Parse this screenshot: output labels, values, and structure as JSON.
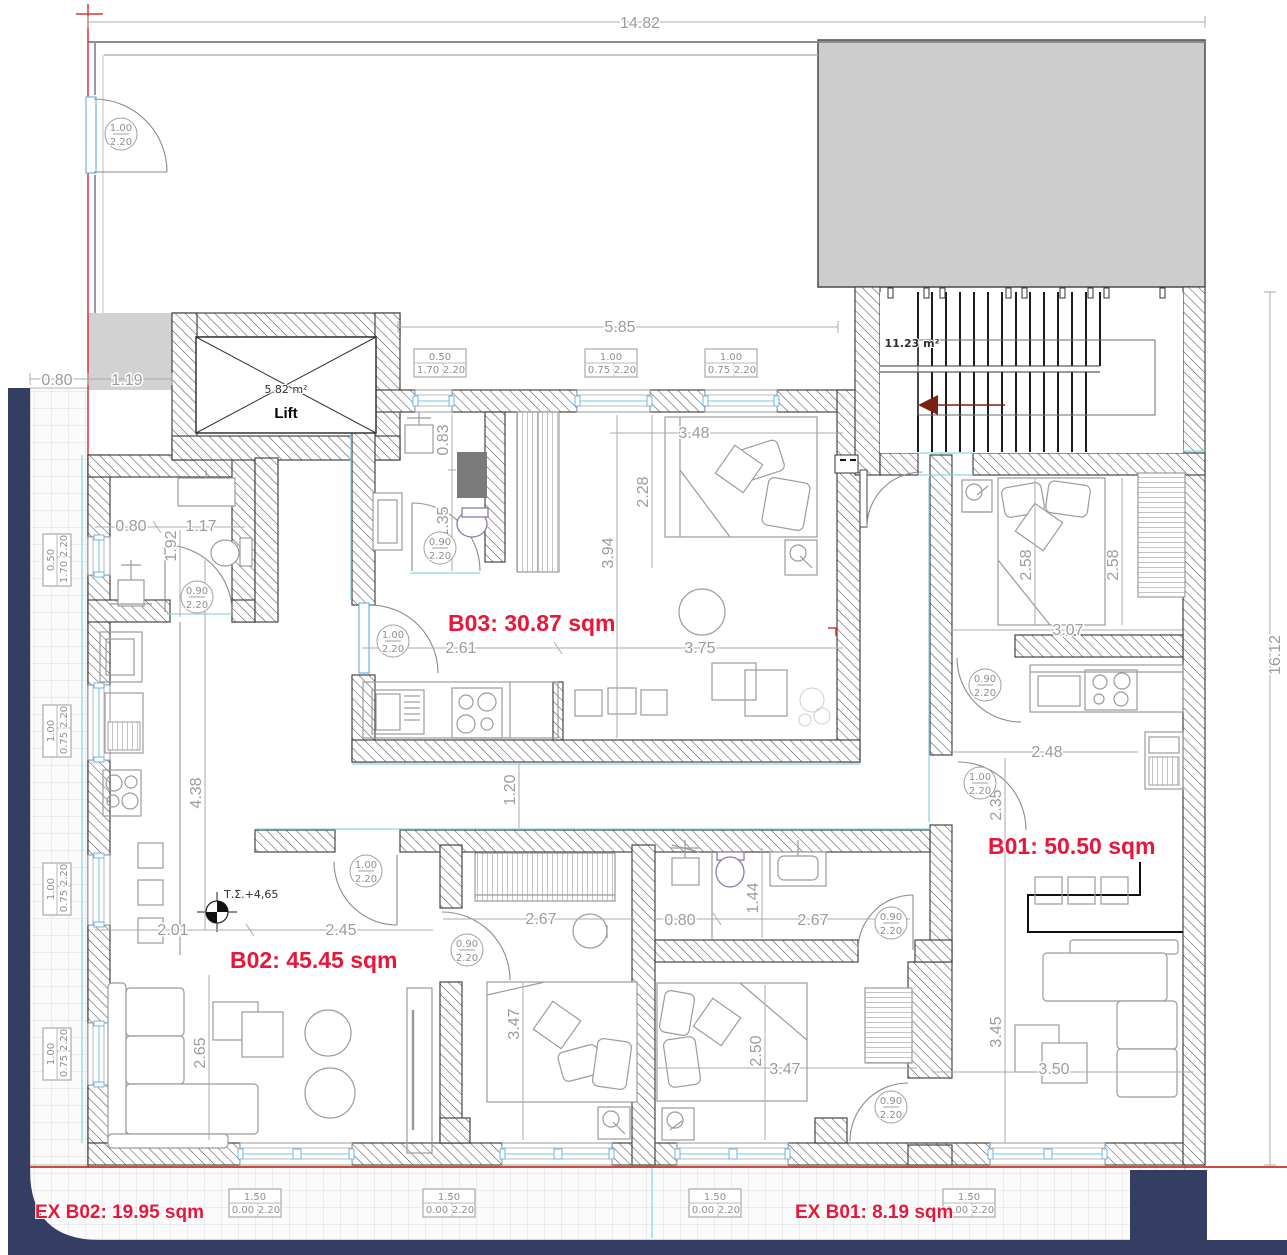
{
  "plan": {
    "room_labels": [
      {
        "text": "B03:  30.87 sqm"
      },
      {
        "text": "B02:  45.45 sqm"
      },
      {
        "text": "B01:  50.50 sqm"
      },
      {
        "text": "EX B02:  19.95 sqm"
      },
      {
        "text": "EX B01:  8.19 sqm"
      }
    ],
    "annotations": {
      "lift_area": "5.82 m²",
      "lift_name": "Lift",
      "stair_area": "11.23 m²",
      "level_mark": "Τ.Σ.+4,65"
    },
    "dimensions": [
      {
        "t": "14.82"
      },
      {
        "t": "16.12"
      },
      {
        "t": "0.80"
      },
      {
        "t": "1.19"
      },
      {
        "t": "5.85"
      },
      {
        "t": "0.83"
      },
      {
        "t": "1.35"
      },
      {
        "t": "3.94"
      },
      {
        "t": "2.28"
      },
      {
        "t": "3.48"
      },
      {
        "t": "2.61"
      },
      {
        "t": "3.75"
      },
      {
        "t": "2.58"
      },
      {
        "t": "2.58"
      },
      {
        "t": "3.07"
      },
      {
        "t": "2.48"
      },
      {
        "t": "2.35"
      },
      {
        "t": "1.20"
      },
      {
        "t": "4.38"
      },
      {
        "t": "0.80"
      },
      {
        "t": "1.17"
      },
      {
        "t": "1.92"
      },
      {
        "t": "2.01"
      },
      {
        "t": "2.45"
      },
      {
        "t": "2.65"
      },
      {
        "t": "2.67"
      },
      {
        "t": "0.80"
      },
      {
        "t": "2.67"
      },
      {
        "t": "1.44"
      },
      {
        "t": "3.47"
      },
      {
        "t": "2.50"
      },
      {
        "t": "3.47"
      },
      {
        "t": "3.45"
      },
      {
        "t": "3.50"
      }
    ],
    "door_tags": [
      {
        "w": "1.00",
        "h": "2.20"
      },
      {
        "w": "0.90",
        "h": "2.20"
      },
      {
        "w": "0.90",
        "h": "2.20"
      },
      {
        "w": "1.00",
        "h": "2.20"
      },
      {
        "w": "1.00",
        "h": "2.20"
      },
      {
        "w": "0.90",
        "h": "2.20"
      },
      {
        "w": "0.90",
        "h": "2.20"
      },
      {
        "w": "1.00",
        "h": "2.20"
      },
      {
        "w": "0.90",
        "h": "2.20"
      },
      {
        "w": "0.90",
        "h": "2.20"
      }
    ],
    "window_tags": [
      {
        "w": "0.50",
        "sill": "1.70",
        "h": "2.20"
      },
      {
        "w": "1.00",
        "sill": "0.75",
        "h": "2.20"
      },
      {
        "w": "1.00",
        "sill": "0.75",
        "h": "2.20"
      },
      {
        "w": "0.50",
        "sill": "1.70",
        "h": "2.20"
      },
      {
        "w": "1.00",
        "sill": "0.75",
        "h": "2.20"
      },
      {
        "w": "1.00",
        "sill": "0.75",
        "h": "2.20"
      },
      {
        "w": "1.00",
        "sill": "0.75",
        "h": "2.20"
      },
      {
        "w": "1.50",
        "sill": "0.00",
        "h": "2.20"
      },
      {
        "w": "1.50",
        "sill": "0.00",
        "h": "2.20"
      },
      {
        "w": "1.50",
        "sill": "0.00",
        "h": "2.20"
      },
      {
        "w": "1.50",
        "sill": "0.00",
        "h": "2.20"
      }
    ],
    "colors": {
      "room_label_red": "#e8173a",
      "boundary_red": "#cf3a30",
      "parapet_navy": "#343e63",
      "window_cyan": "#8fd5e5",
      "stair_arrow_red": "#7c2014",
      "neighbor_building_fill": "#cdcdcd",
      "dimension_gray": "#9c9c9c"
    }
  }
}
